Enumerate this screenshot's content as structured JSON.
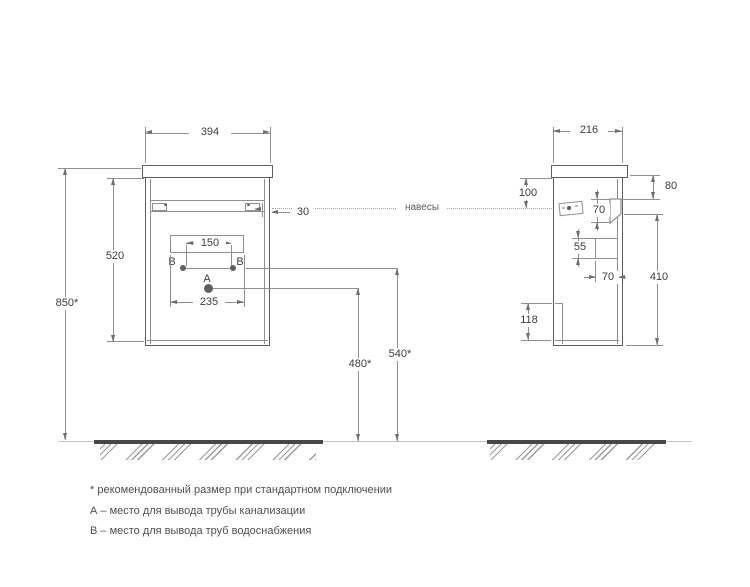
{
  "front_view": {
    "width": "394",
    "height": "520",
    "install_height": "850*",
    "rail_offset": "30",
    "hangers_label": "навесы",
    "holes_span": "150",
    "holes_outer_span": "235",
    "hole_a": "A",
    "hole_b_left": "B",
    "hole_b_right": "B",
    "drain_height": "480*",
    "supply_height": "540*"
  },
  "side_view": {
    "depth": "216",
    "hanger_top_offset": "100",
    "back_top_offset": "80",
    "bracket_height": "70",
    "slot_height": "55",
    "slot_width": "70",
    "back_height": "410",
    "bottom_panel_height": "118"
  },
  "notes": {
    "recommended": "* рекомендованный размер при стандартном подключении",
    "a_note": "А – место для вывода трубы канализации",
    "b_note": "В – место для вывода труб водоснабжения"
  },
  "colors": {
    "outline": "#5d5d5d",
    "dim_line": "#8f8f8f",
    "text": "#3d3d3d",
    "floor": "#474747"
  }
}
